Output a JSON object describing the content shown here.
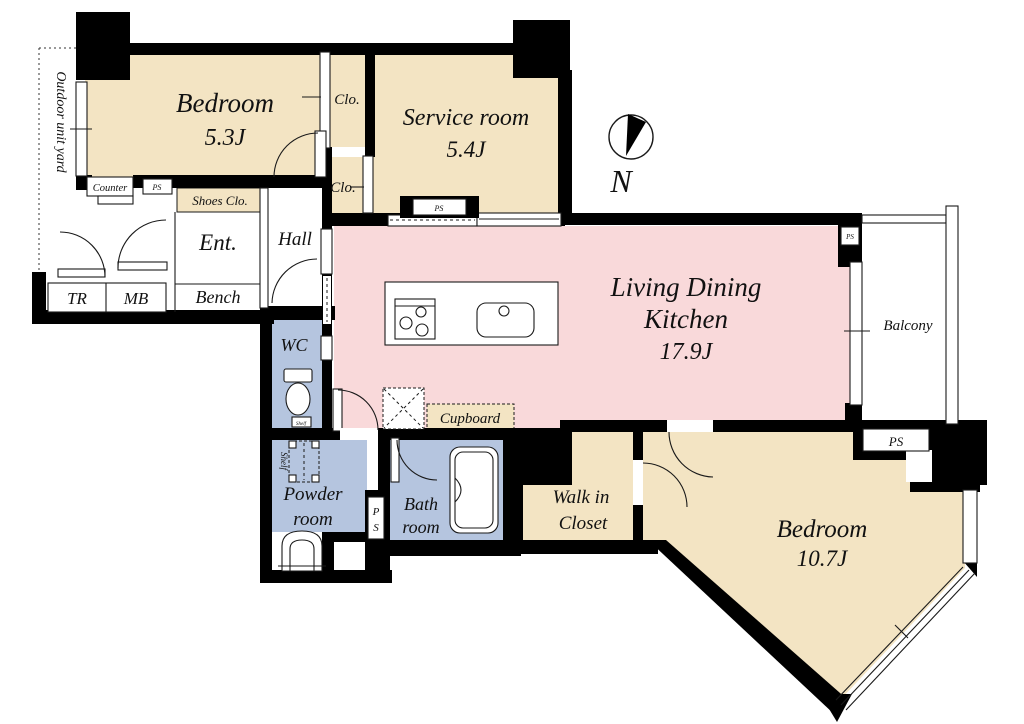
{
  "plan": {
    "compass_label": "N",
    "ps_label": "PS",
    "ps_stacked": {
      "top": "P",
      "bottom": "S"
    },
    "colors": {
      "room_beige": "#F3E4C3",
      "ldk_pink": "#F9D9DA",
      "wet_blue": "#B5C5DF",
      "wall": "#000000",
      "floor_white": "#FFFFFF"
    },
    "rooms": {
      "bedroom1": {
        "name": "Bedroom",
        "size": "5.3J"
      },
      "closet_top": {
        "name": "Clo."
      },
      "closet_mid": {
        "name": "Clo."
      },
      "service_room": {
        "name": "Service room",
        "size": "5.4J"
      },
      "entrance": {
        "name": "Ent."
      },
      "bench": {
        "name": "Bench"
      },
      "hall": {
        "name": "Hall"
      },
      "shoes_closet": {
        "name": "Shoes Clo."
      },
      "counter": {
        "name": "Counter"
      },
      "tr": {
        "name": "TR"
      },
      "mb": {
        "name": "MB"
      },
      "wc": {
        "name": "WC"
      },
      "ldk": {
        "name_line1": "Living Dining",
        "name_line2": "Kitchen",
        "size": "17.9J"
      },
      "balcony": {
        "name": "Balcony"
      },
      "cupboard": {
        "name": "Cupboard"
      },
      "powder_room": {
        "line1": "Powder",
        "line2": "room"
      },
      "bath_room": {
        "line1": "Bath",
        "line2": "room"
      },
      "walk_in_closet": {
        "line1": "Walk in",
        "line2": "Closet"
      },
      "bedroom2": {
        "name": "Bedroom",
        "size": "10.7J"
      },
      "outdoor_unit_yard": {
        "name": "Outdoor unit yard"
      },
      "shelf": {
        "name": "Shelf"
      }
    }
  }
}
